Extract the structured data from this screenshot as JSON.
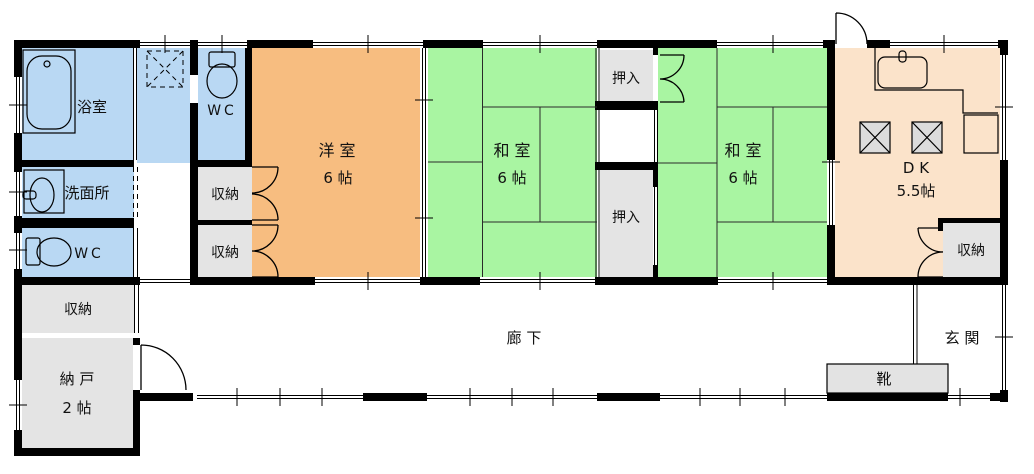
{
  "title": "floor-plan",
  "colors": {
    "wet_area_blue": "#b9d8f3",
    "tatami_green": "#a9f5a2",
    "western_orange": "#f7bd80",
    "dk_peach": "#fbe3ca",
    "storage_gray": "#e4e4e4",
    "stove_gray": "#dcdcdc",
    "wall_black": "#000000",
    "background": "#ffffff"
  },
  "rooms": {
    "bathroom": {
      "label": "浴室"
    },
    "washroom": {
      "label": "洗面所"
    },
    "wc_upper": {
      "label": "WC"
    },
    "wc_lower": {
      "label": "WC"
    },
    "western_room": {
      "label": "洋 室",
      "size": "6 帖"
    },
    "japanese_room_1": {
      "label": "和 室",
      "size": "6 帖"
    },
    "japanese_room_2": {
      "label": "和 室",
      "size": "6 帖"
    },
    "dining_kitchen": {
      "label": "D K",
      "size": "5.5帖"
    },
    "storeroom": {
      "label": "納 戸",
      "size": "2 帖"
    },
    "corridor": {
      "label": "廊 下"
    },
    "entrance": {
      "label": "玄 関"
    },
    "closet_upper": {
      "label": "押入"
    },
    "closet_lower": {
      "label": "押入"
    },
    "storage_hall_upper": {
      "label": "収納"
    },
    "storage_hall_lower": {
      "label": "収納"
    },
    "storage_west": {
      "label": "収納"
    },
    "storage_dk": {
      "label": "収納"
    },
    "shoe_cabinet": {
      "label": "靴"
    }
  }
}
